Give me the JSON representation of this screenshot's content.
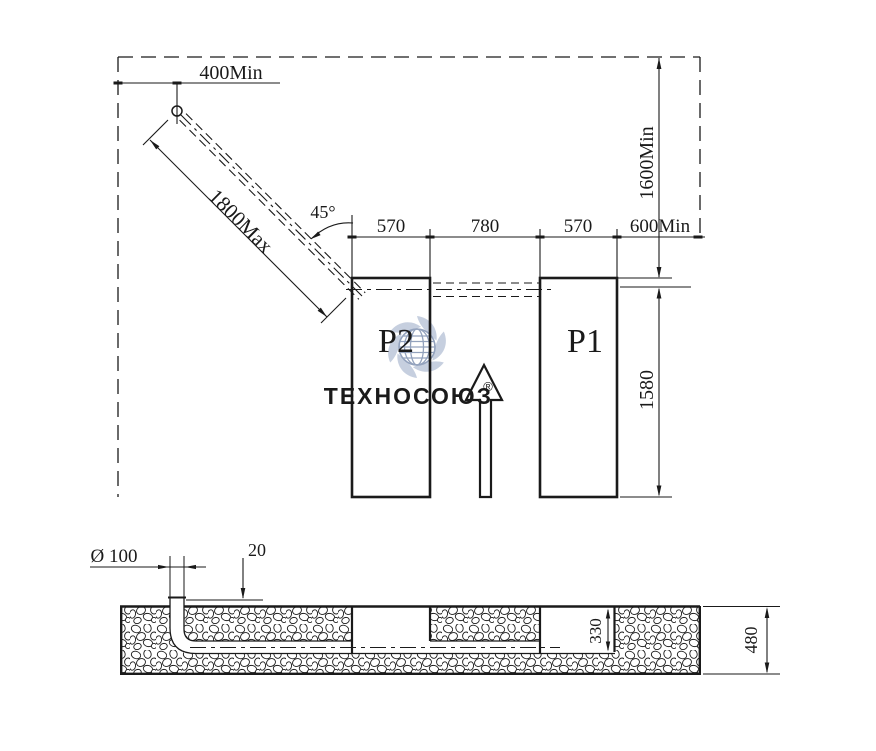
{
  "colors": {
    "background": "#ffffff",
    "line": "#1a1a1a",
    "watermark_petal": "#c6cfdf",
    "watermark_globe": "#93a2bd",
    "watermark_text_dark": "#8f9ab3",
    "watermark_text_light": "#bcc6d8"
  },
  "watermark": {
    "brand_left": "ТЕХНО",
    "brand_right": "СОЮЗ",
    "registered": "®"
  },
  "plan": {
    "offset_top": "400Min",
    "arm_length": "1800Max",
    "arm_angle": "45°",
    "span_p2": "570",
    "span_gap": "780",
    "span_p1": "570",
    "span_edge": "600Min",
    "clearance_height": "1600Min",
    "post_length": "1580",
    "post_left": "P2",
    "post_right": "P1"
  },
  "section": {
    "pipe_diameter": "Ø 100",
    "pipe_protrusion": "20",
    "pipe_depth": "330",
    "slab_depth": "480"
  }
}
